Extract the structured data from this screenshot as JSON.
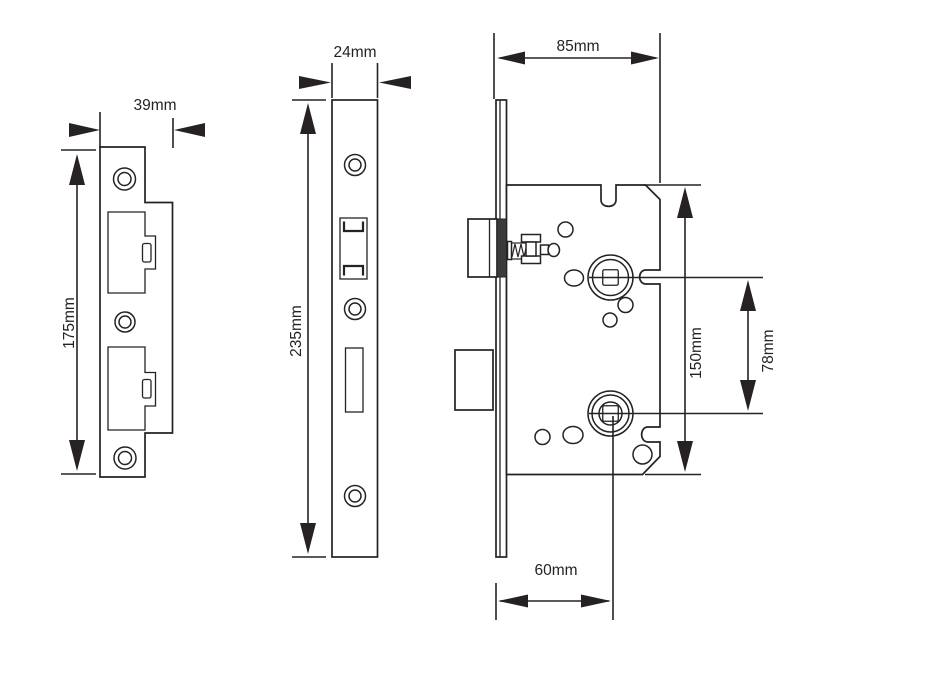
{
  "drawing": {
    "background_color": "#ffffff",
    "line_color": "#262223",
    "views": {
      "strike_plate": {
        "width_label": "39mm",
        "height_label": "175mm"
      },
      "faceplate": {
        "width_label": "24mm",
        "height_label": "235mm"
      },
      "lock_body": {
        "width_label": "85mm",
        "height_label": "150mm",
        "hub_spacing_label": "78mm",
        "backset_label": "60mm"
      }
    }
  }
}
